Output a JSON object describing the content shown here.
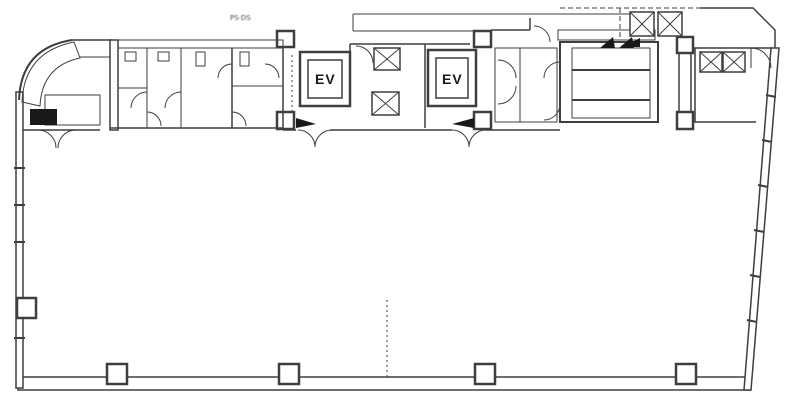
{
  "plan": {
    "ev1_label": "EV",
    "ev2_label": "EV",
    "annotation_text": "PS·DS",
    "colors": {
      "ink": "#3f3f3f",
      "ink_dark": "#1b1b1b",
      "paper": "#ffffff"
    }
  }
}
